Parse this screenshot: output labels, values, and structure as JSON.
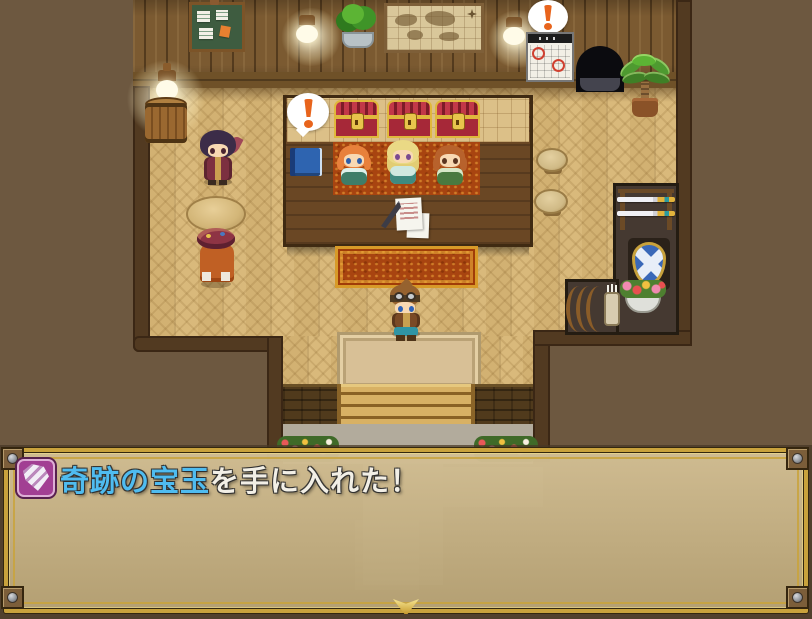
{
  "message_window": {
    "icon": "gem-icon",
    "icon_bg_color": "#a23f93",
    "item_name": "奇跡の宝玉",
    "suffix_text": "を手に入れた！",
    "item_name_color": "#4fbcf0",
    "text_color": "#f2efe6",
    "frame_color": "#c9a23c",
    "window_fill": "#cdb584",
    "cursor": "continue-arrow-down"
  },
  "scene": {
    "balloon_symbol": "!",
    "npcs": [
      "black-haired-adventurer",
      "hooded-merchant-back",
      "clerk-orange-hair",
      "clerk-blonde",
      "clerk-auburn-hair",
      "hero-with-goggles"
    ],
    "objects": [
      "bulletin-board",
      "wall-lantern-left",
      "potted-bush",
      "wall-map",
      "wall-lantern-right",
      "wall-calendar",
      "calendar-surprise-balloon",
      "wall-opening",
      "potted-palm",
      "barrel-with-lantern",
      "round-table",
      "counter",
      "treasure-chest-1",
      "treasure-chest-2",
      "treasure-chest-3",
      "ledger-book",
      "quill-and-papers",
      "counter-surprise-balloon",
      "staff-carpet",
      "front-rug",
      "stool-1",
      "stool-2",
      "weapon-display",
      "sword-rack",
      "shield-display",
      "flower-basket",
      "bow-rack",
      "arrow-quiver",
      "entrance-mat",
      "steps",
      "stone-path",
      "flower-bed-left",
      "flower-bed-right"
    ]
  },
  "colors": {
    "outdoor": "#6d5840",
    "wall": "#7b5a31",
    "floor": "#d9b97b",
    "carpet_red": "#a84410",
    "counter_wood": "#6a4724"
  }
}
